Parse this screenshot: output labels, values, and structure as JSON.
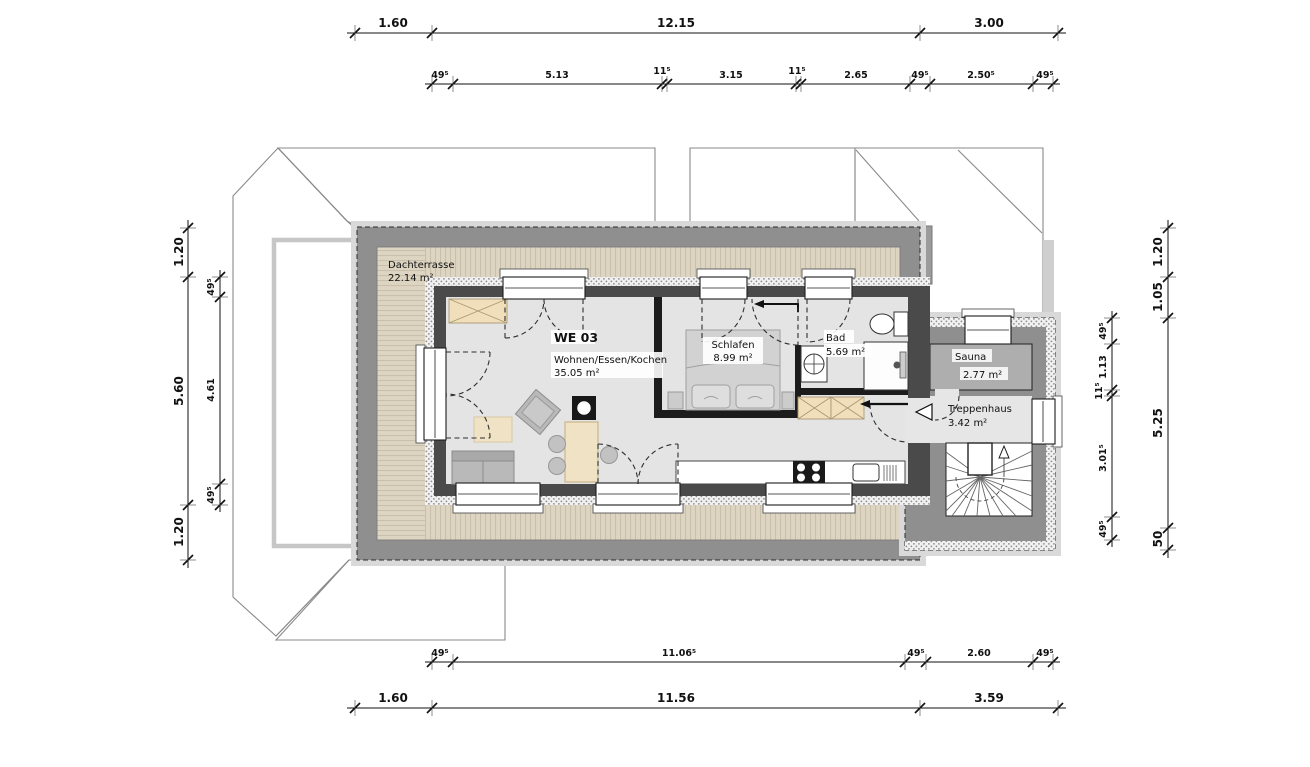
{
  "plan": {
    "type": "floor-plan",
    "unit_label": "WE 03"
  },
  "rooms": {
    "dachterrasse": {
      "name": "Dachterrasse",
      "area": "22.14 m²"
    },
    "we03": {
      "unit": "WE 03",
      "use": "Wohnen/Essen/Kochen",
      "area": "35.05 m²"
    },
    "schlafen": {
      "name": "Schlafen",
      "area": "8.99 m²"
    },
    "bad": {
      "name": "Bad",
      "area": "5.69 m²"
    },
    "sauna": {
      "name": "Sauna",
      "area": "2.77 m²"
    },
    "treppenhaus": {
      "name": "Treppenhaus",
      "area": "3.42 m²"
    }
  },
  "dimensions": {
    "top_outer": [
      "1.60",
      "12.15",
      "3.00"
    ],
    "top_inner": [
      "49⁵",
      "5.13",
      "11⁵",
      "3.15",
      "11⁵",
      "2.65",
      "49⁵",
      "2.50⁵",
      "49⁵"
    ],
    "bottom_inner": [
      "49⁵",
      "11.06⁵",
      "49⁵",
      "2.60",
      "49⁵"
    ],
    "bottom_outer": [
      "1.60",
      "11.56",
      "3.59"
    ],
    "left_outer": [
      "1.20",
      "5.60",
      "1.20"
    ],
    "left_inner": [
      "49⁵",
      "4.61",
      "49⁵"
    ],
    "right_outer": [
      "1.20",
      "1.05",
      "5.25",
      "50"
    ],
    "right_inner": [
      "49⁵",
      "1.13",
      "11⁵",
      "3.01⁵",
      "49⁵"
    ]
  },
  "colors": {
    "parapet": "#8f8f8f",
    "decking": "#ddd5c2",
    "interior_floor": "#e4e4e4",
    "sauna_floor": "#aeaeae",
    "wall_dark": "#4a4a4a",
    "partition": "#1c1c1c",
    "furniture_gray": "#b9b9b9",
    "wood_beige": "#f0dfba"
  }
}
